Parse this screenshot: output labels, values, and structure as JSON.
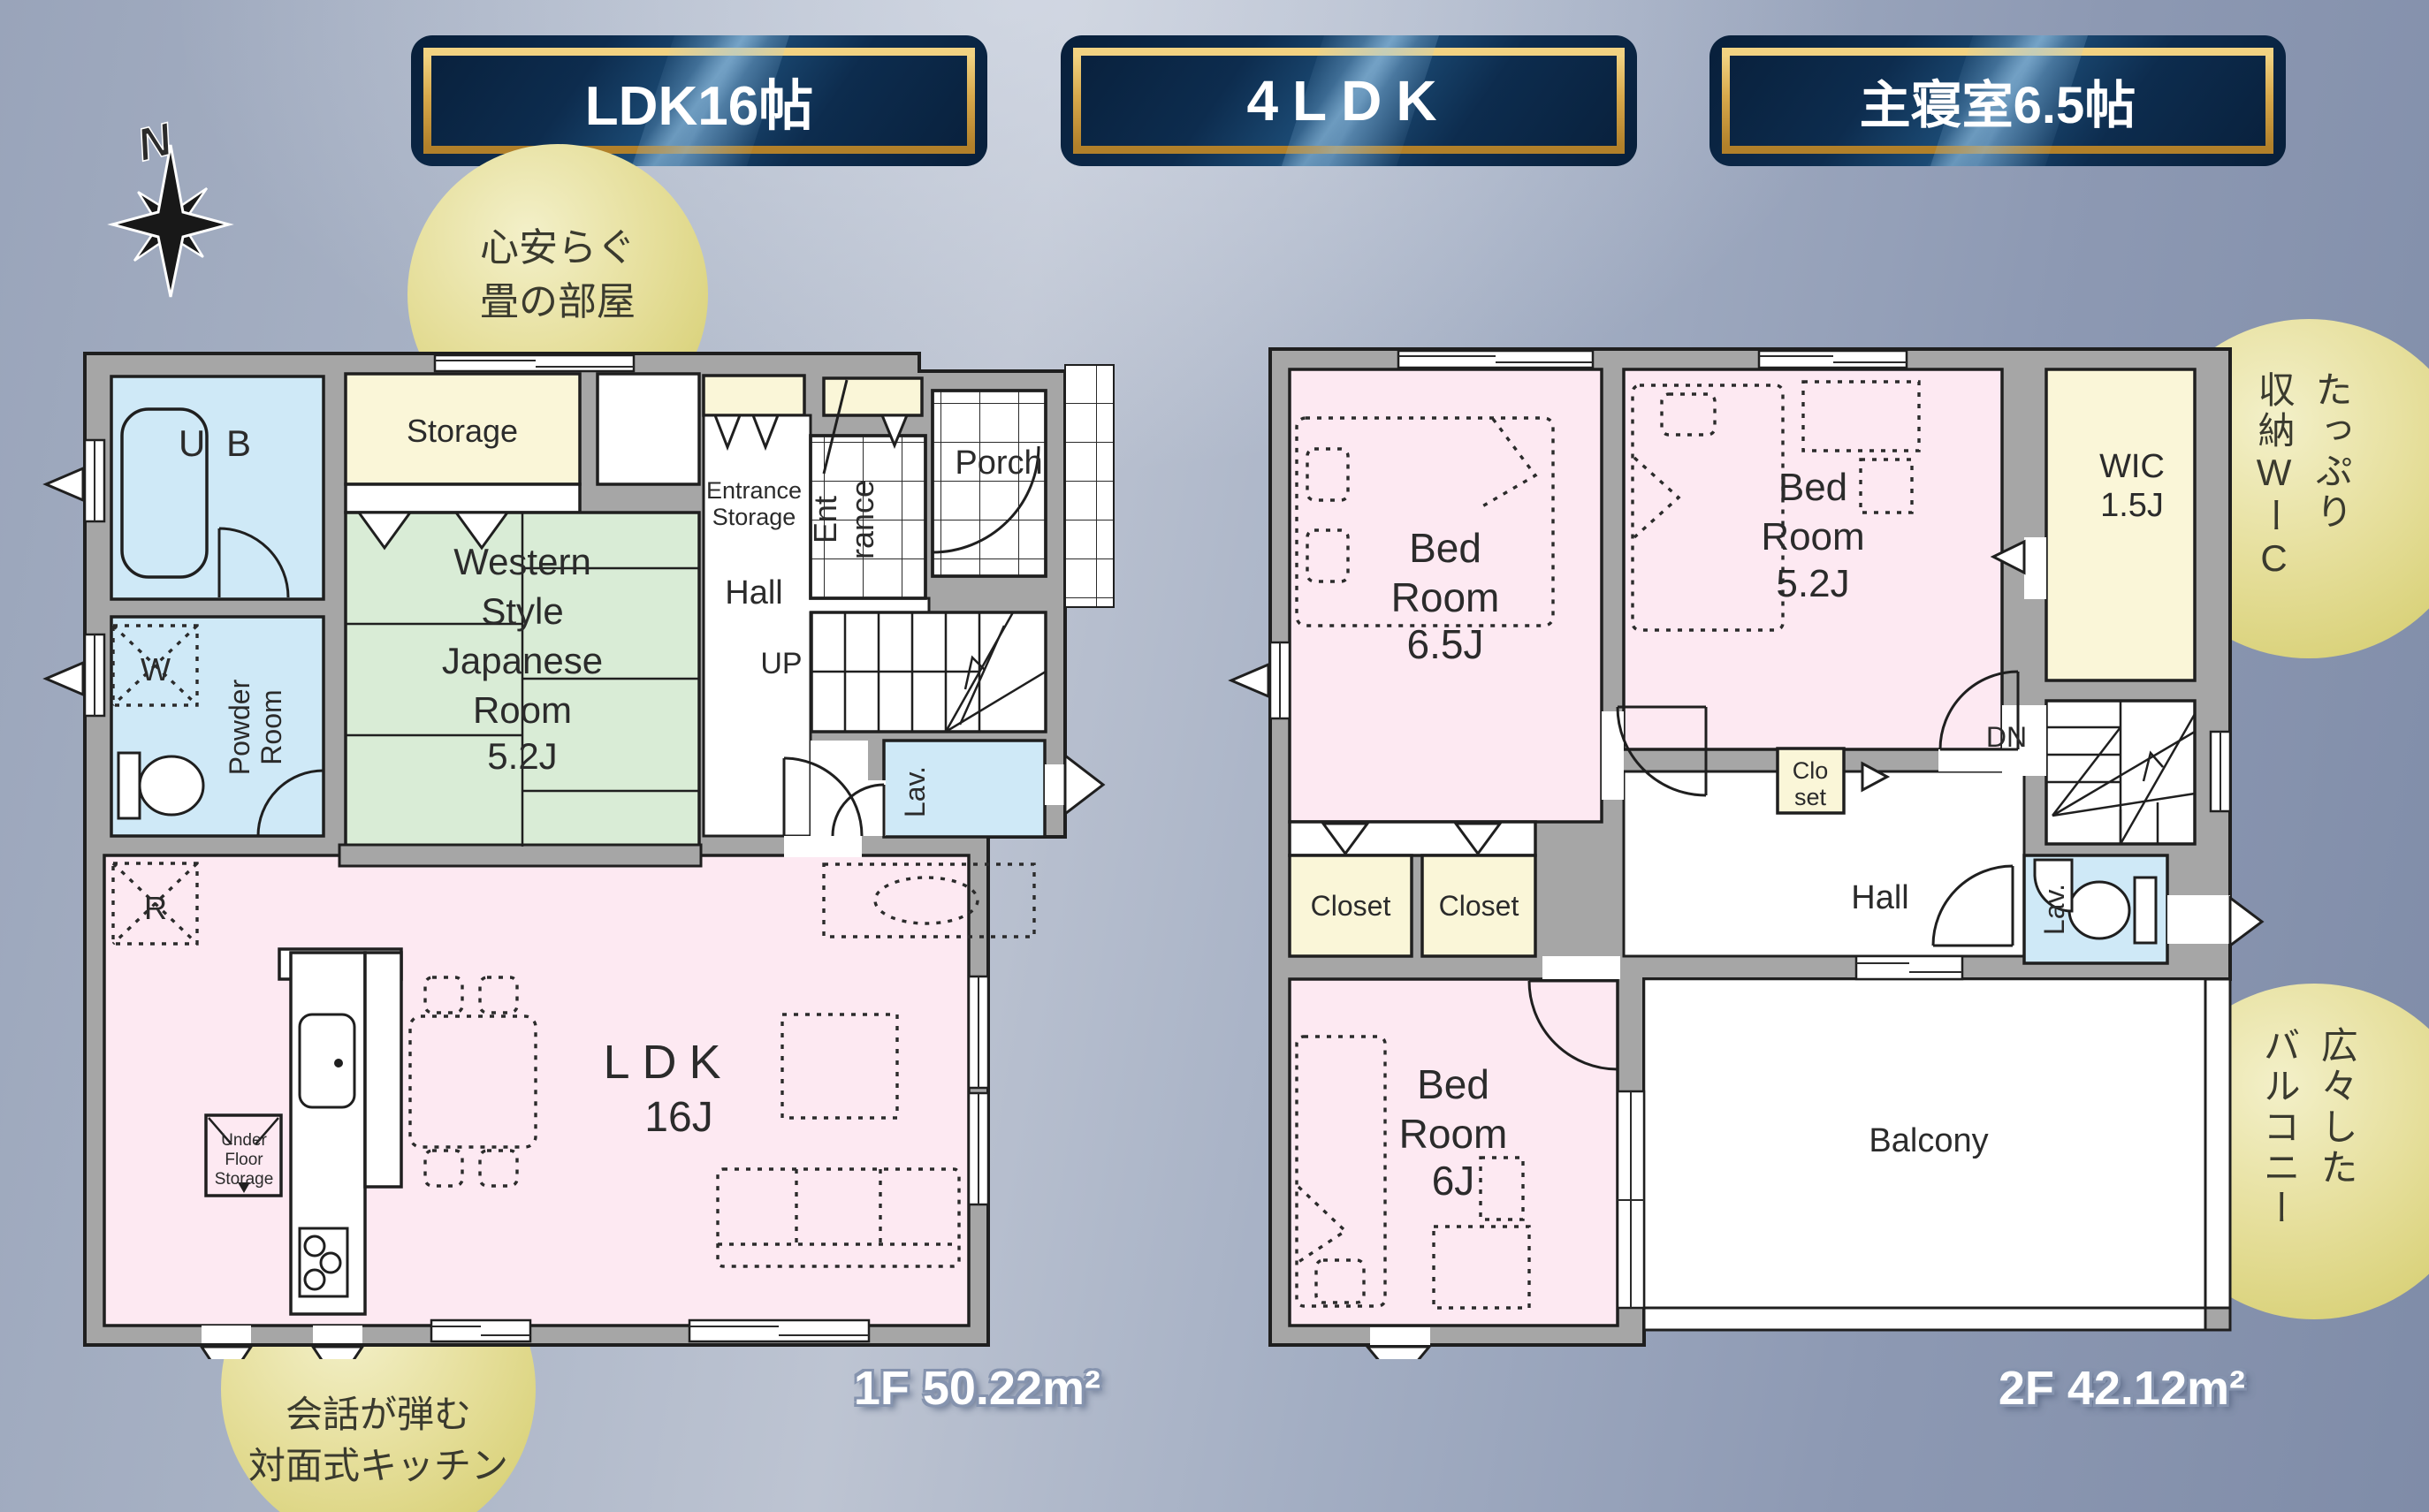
{
  "badges": [
    {
      "label": "LDK16帖"
    },
    {
      "label": "4LDK"
    },
    {
      "label": "主寝室6.5帖"
    }
  ],
  "compass": {
    "label": "N"
  },
  "callouts": {
    "tatami": {
      "lines": [
        "心安らぐ",
        "畳の部屋"
      ]
    },
    "kitchen": {
      "lines": [
        "会話が弾む",
        "対面式キッチン"
      ]
    },
    "wic": {
      "cols": [
        "たっぷり",
        "収納WーC"
      ]
    },
    "balcony": {
      "cols": [
        "広々した",
        "バルコニー"
      ]
    }
  },
  "f1": {
    "area": "1F 50.22m²",
    "ub": "U B",
    "storage": "Storage",
    "entstor": [
      "Entrance",
      "Storage"
    ],
    "ent": [
      "Ent",
      "rance"
    ],
    "porch": "Porch",
    "hall": "Hall",
    "up": "UP",
    "lav": "Lav.",
    "powder": [
      "Powder",
      "Room"
    ],
    "washer": "W",
    "fridge": "R",
    "jroom": [
      "Western",
      "Style",
      "Japanese",
      "Room",
      "5.2J"
    ],
    "ldk": [
      "LDK",
      "16J"
    ],
    "ufs": [
      "Under",
      "Floor",
      "Storage"
    ]
  },
  "f2": {
    "area": "2F 42.12m²",
    "bed65": [
      "Bed",
      "Room",
      "6.5J"
    ],
    "bed52": [
      "Bed",
      "Room",
      "5.2J"
    ],
    "wic": [
      "WIC",
      "1.5J"
    ],
    "closet1": "Closet",
    "closet2": "Closet",
    "closet_s": [
      "Clo",
      "set"
    ],
    "hall": "Hall",
    "dn": "DN",
    "lav": "Lav.",
    "bed6": [
      "Bed",
      "Room",
      "6J"
    ],
    "balcony": "Balcony"
  },
  "palette": {
    "badge_navy": "#0d2c4e",
    "badge_gold": "#d4a140",
    "wall_gray": "#a6a6a6",
    "room_pink": "#fde9f2",
    "room_blue": "#cfe9f7",
    "room_yellow": "#faf6d8",
    "room_green": "#d9ecd6",
    "callout_yellow": "#ded673",
    "background_blue": "#9aa6bd"
  }
}
